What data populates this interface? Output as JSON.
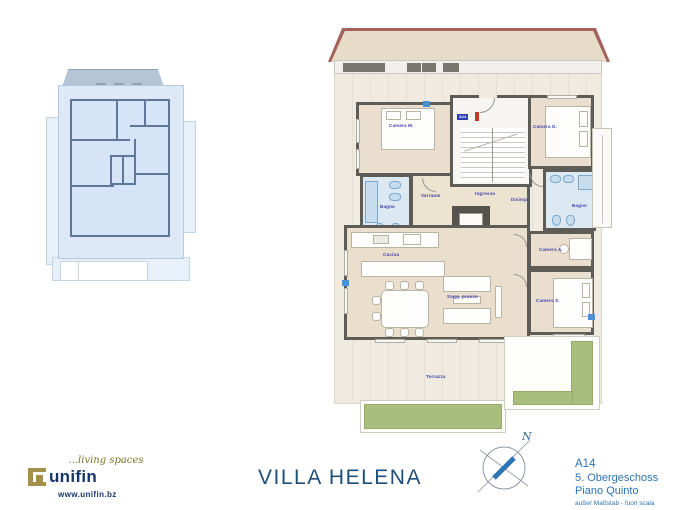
{
  "title": "VILLA HELENA",
  "branding": {
    "tagline": "...living spaces",
    "company": "unifin",
    "website": "www.unifin.bz"
  },
  "project_info": {
    "unit": "A14",
    "floor_de": "5. Obergeschoss",
    "floor_it": "Piano Quinto",
    "scale_note": "außer Maßstab - fuori scala"
  },
  "compass": {
    "north": "N"
  },
  "main_plan": {
    "entry_tag": "A14",
    "rooms": {
      "camera_m": "Camera M.",
      "bagno_sx": "Bagno",
      "vorraum": "Vorraum",
      "ingresso": "Ingresso",
      "disimp": "Disimp.",
      "camera_d": "Camera D.",
      "bagno_dx": "Bagno",
      "camera_a": "Camera A.",
      "camera_s": "Camera S.",
      "cucina": "Cucina",
      "soggiorno": "Sogg. pranzo",
      "terrazza": "Terrazza"
    }
  },
  "colors": {
    "wall": "#5d5c57",
    "wood_floor": "#eadfce",
    "bath_floor": "#dce9f3",
    "terrace": "#f0ebe1",
    "roof_edge": "#a5625c",
    "roof_fill": "#e7dcc7",
    "green": "#a9bd7d",
    "label_blue": "#3d3da8",
    "title_blue": "#1f4e79",
    "info_blue": "#2e74b5",
    "brand_navy": "#16366b",
    "brand_gold": "#a3904b",
    "mini_plan_blue": "#dde9f7"
  }
}
